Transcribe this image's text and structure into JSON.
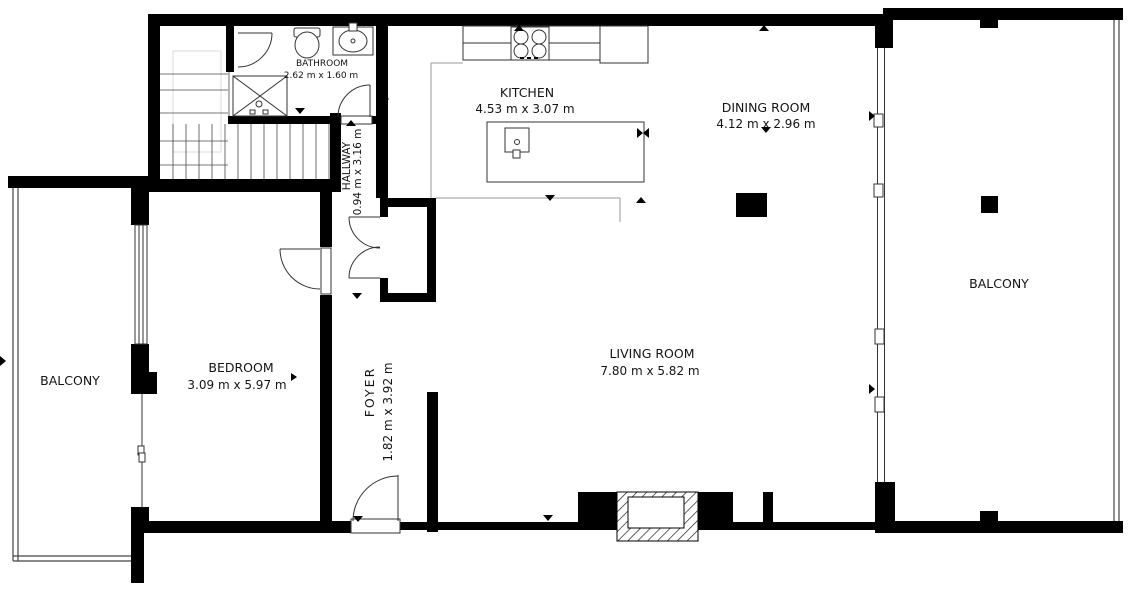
{
  "floorplan": {
    "rooms": [
      {
        "name": "BATHROOM",
        "dims": "2.62 m x 1.60 m"
      },
      {
        "name": "KITCHEN",
        "dims": "4.53 m x 3.07 m"
      },
      {
        "name": "DINING ROOM",
        "dims": "4.12 m x 2.96 m"
      },
      {
        "name": "HALLWAY",
        "dims": "0.94 m x 3.16 m"
      },
      {
        "name": "BEDROOM",
        "dims": "3.09 m x 5.97 m"
      },
      {
        "name": "FOYER",
        "dims": "1.82 m x 3.92 m"
      },
      {
        "name": "LIVING ROOM",
        "dims": "7.80 m x 5.82 m"
      },
      {
        "name": "BALCONY"
      },
      {
        "name": "BALCONY"
      }
    ],
    "colors": {
      "wall": "#000000",
      "background": "#ffffff",
      "fixture_stroke": "#333333",
      "guide": "#d9d9d9",
      "text": "#141414"
    }
  }
}
